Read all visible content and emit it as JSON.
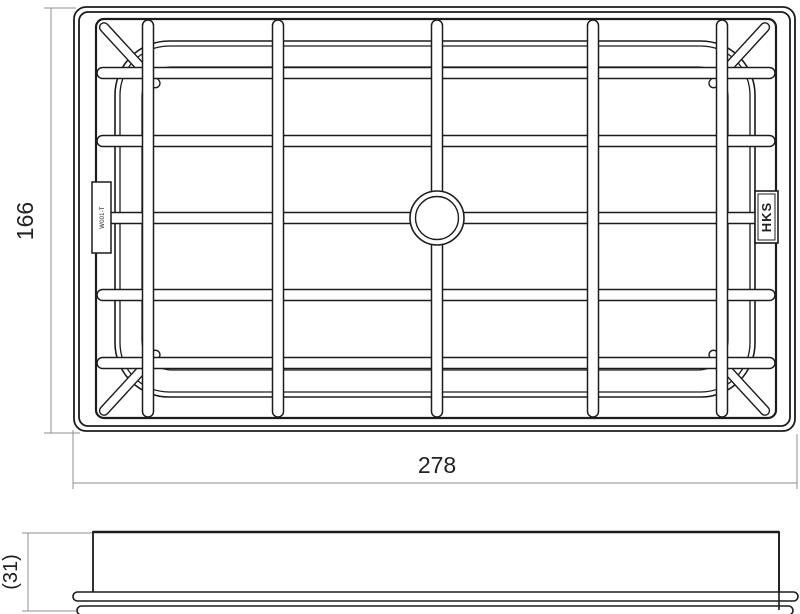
{
  "colors": {
    "line": "#1c1c1c",
    "dim": "#8f8f8f",
    "text": "#222222",
    "background": "#ffffff"
  },
  "top_view": {
    "part_label": "W001-T",
    "brand_label": "HKS"
  },
  "dimensions": {
    "height": "166",
    "width": "278",
    "thickness": "(31)"
  }
}
